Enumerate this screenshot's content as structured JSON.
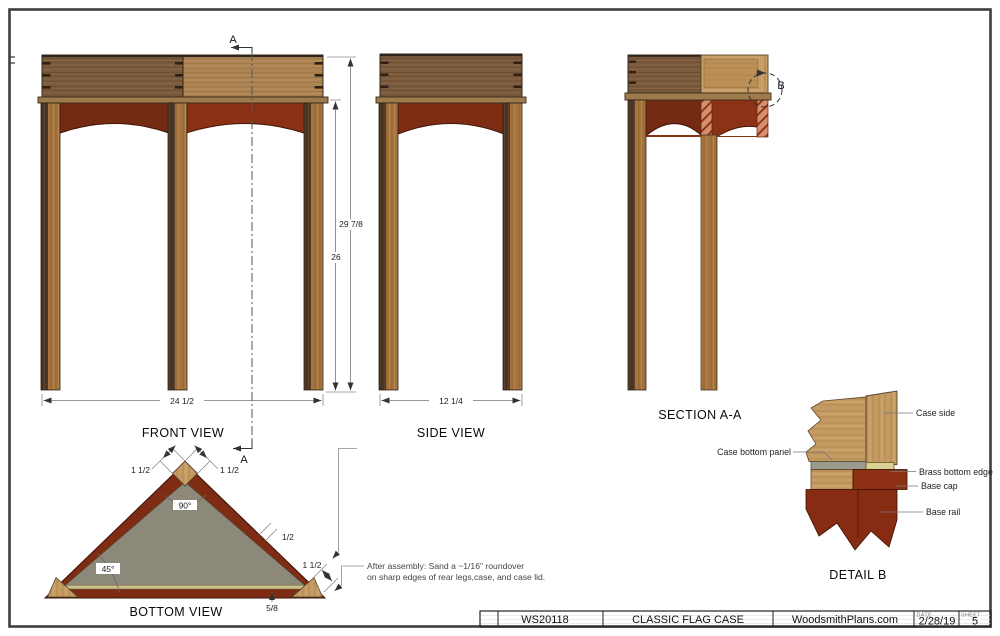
{
  "views": {
    "front_view": {
      "label": "FRONT VIEW",
      "dim_overall_height": "29 7/8",
      "dim_leg_height": "26",
      "dim_width": "24 1/2"
    },
    "side_view": {
      "label": "SIDE VIEW",
      "dim_depth": "12 1/4"
    },
    "section_aa": {
      "label": "SECTION A-A",
      "detail_marker": "B"
    },
    "bottom_view": {
      "label": "BOTTOM VIEW",
      "dim_leg_left": "1 1/2",
      "dim_leg_right": "1 1/2",
      "angle_apex": "90°",
      "angle_base": "45°",
      "dim_case_side": "1/2",
      "dim_leg_corner": "1 1/2",
      "dim_base_molding": "5/8"
    },
    "detail_b": {
      "label": "DETAIL  B",
      "callout_case_side": "Case side",
      "callout_case_bottom_panel": "Case bottom panel",
      "callout_brass_bottom_edge": "Brass bottom edge",
      "callout_base_cap": "Base cap",
      "callout_base_rail": "Base rail"
    }
  },
  "section_line": {
    "marker_top": "A",
    "marker_bottom": "A"
  },
  "note": {
    "line1": "After assembly: Sand a ~1/16\" roundover",
    "line2": "on sharp edges of rear legs,case, and case lid."
  },
  "title_block": {
    "plan_number": "WS20118",
    "title": "CLASSIC FLAG CASE",
    "publisher": "WoodsmithPlans.com",
    "date_label": "DATE",
    "date": "2/28/19",
    "sheet_label": "SHEET",
    "sheet_number": "5"
  },
  "colors": {
    "wood_dark": "#7b5b3d",
    "wood_light": "#ad8454",
    "leg_dark": "#4e3927",
    "leg_light": "#a6753f",
    "apron_red": "#7e2c13",
    "apron_red_bright": "#8c3316",
    "section_hatch": "#d4906c",
    "bottom_panel_gray": "#8c897a",
    "brass": "#dbcf92",
    "detail_tan": "#c49b63",
    "page_border": "#3f3f3f"
  }
}
